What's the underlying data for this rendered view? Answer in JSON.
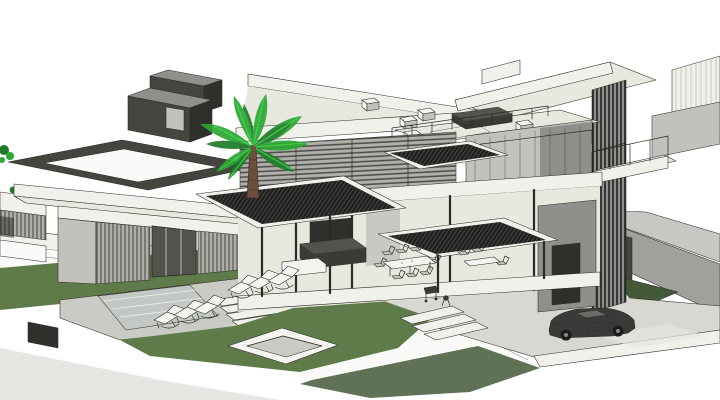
{
  "view": {
    "width": 720,
    "height": 400,
    "kind": "3d-architectural-model-render",
    "visible_text": []
  },
  "palette": {
    "sky": "#ffffff",
    "line": "#2a2a26",
    "paper": "#fafaf8",
    "terrain": "#d8d8d3",
    "deck": "#cbcbc5",
    "pool": "#c3c8c4",
    "slope": "#a0a09c",
    "slope_light": "#c7c7c3",
    "grass": "#5f7b49",
    "grass_dark": "#43593a",
    "wall_white": "#f1f1ec",
    "roof_cream": "#e9e8df",
    "wall_gray": "#c2c2bd",
    "wall_gray2": "#8f8f8b",
    "louver_gray": "#b0b0ab",
    "volume_dark": "#45453f",
    "volume_darker": "#2f2f2c",
    "canopy": "#20201e",
    "glass": "#e8eceb",
    "furn_dark": "#3a3a36",
    "furn_white": "#f4f4f0",
    "trunk": "#6b4e3c",
    "palm": "#2aa834",
    "palm_bright": "#39d13f",
    "palm_dark": "#1e7c28",
    "car": "#3a3a38",
    "shadow": "#e6e6e2"
  },
  "scene": {
    "objects": [
      {
        "name": "modern-villa"
      },
      {
        "name": "palm-tree"
      },
      {
        "name": "hillside-slope"
      },
      {
        "name": "driveway"
      },
      {
        "name": "sports-car"
      },
      {
        "name": "lawn"
      },
      {
        "name": "pool-deck"
      },
      {
        "name": "lap-pool"
      },
      {
        "name": "sun-loungers",
        "count": 6
      },
      {
        "name": "sunken-spa"
      },
      {
        "name": "outdoor-dining-set"
      },
      {
        "name": "living-room-sofa"
      },
      {
        "name": "roof-terrace-furniture"
      },
      {
        "name": "bedroom-bed"
      },
      {
        "name": "louvered-canopies",
        "count": 3
      },
      {
        "name": "rooftop-pergola-frame"
      },
      {
        "name": "dark-chimney-volumes",
        "count": 2
      }
    ]
  }
}
